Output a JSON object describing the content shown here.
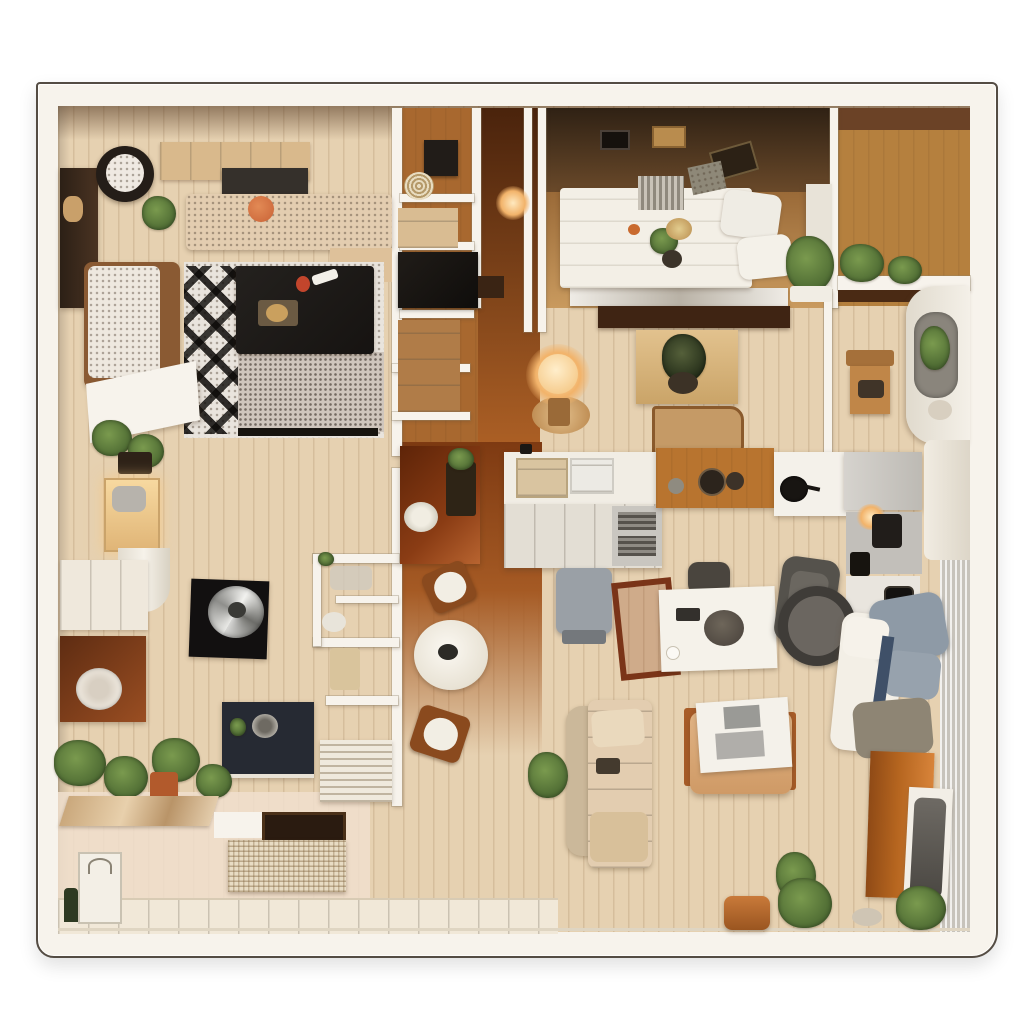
{
  "scene": {
    "type": "3d-floor-plan-top-down-render",
    "rooms": [
      "living-room",
      "hallway-closets",
      "bedroom",
      "kitchen",
      "dining-area",
      "lounge-area",
      "bathroom-nook",
      "entry-nook"
    ],
    "furniture": [
      "papasan-chair",
      "side-cabinet",
      "beige-sofa",
      "coffee-table",
      "chevron-rug",
      "daybed",
      "vanity-desk",
      "black-accent-table",
      "silver-bowl",
      "round-dining-table",
      "dining-chairs",
      "wood-desk",
      "navy-desk",
      "louver-panel",
      "woven-bench",
      "shopping-bag",
      "kitchen-island",
      "island-bench",
      "prep-counter",
      "cooktop-counter",
      "wood-table",
      "sink-counter",
      "fridge-column",
      "double-bed",
      "bed-pillows",
      "floor-lamp",
      "white-work-table",
      "office-chair",
      "gray-armchair",
      "wood-chair",
      "fabric-sofa",
      "tray-ottoman",
      "wood-stool",
      "lounge-bed",
      "terracotta-cabinet",
      "garment-rack",
      "wash-basin",
      "house-plants"
    ]
  },
  "palette": {
    "page-bg": "#ffffff",
    "wall-white": "#f7f3ec",
    "outline-dark": "#544c43",
    "floor-light": "#e6d1b1",
    "floor-pink": "#f0dfce",
    "floor-dark-orange": "#8f4a1c",
    "floor-oak": "#b5803e",
    "band-brown": "#47321f",
    "shelf-brown": "#3f2413",
    "rug-light": "#e9e4dd",
    "rug-dark": "#17140f",
    "sofa-beige": "#e3cdb0",
    "cushion-orange": "#c96236",
    "table-black": "#161311",
    "bowl-silver": "#c9c8c4",
    "island-white": "#f1ede4",
    "bench-gray": "#9aa0a6",
    "counter-wood": "#b8742f",
    "bed-white": "#f3efe6",
    "pillow-blue": "#8e9aa6",
    "terracotta": "#b5651f",
    "plant-green": "#4e6b33",
    "plant-green-light": "#7a9a4e",
    "glow-amber": "#f2b36a",
    "navy-desk": "#262a33",
    "chair-gray": "#55524c",
    "curtain-gray": "#dad6cf",
    "daybed-brown": "#8a5a33",
    "sideboard-red": "#8a3c14",
    "oak-chair": "#c08648"
  }
}
